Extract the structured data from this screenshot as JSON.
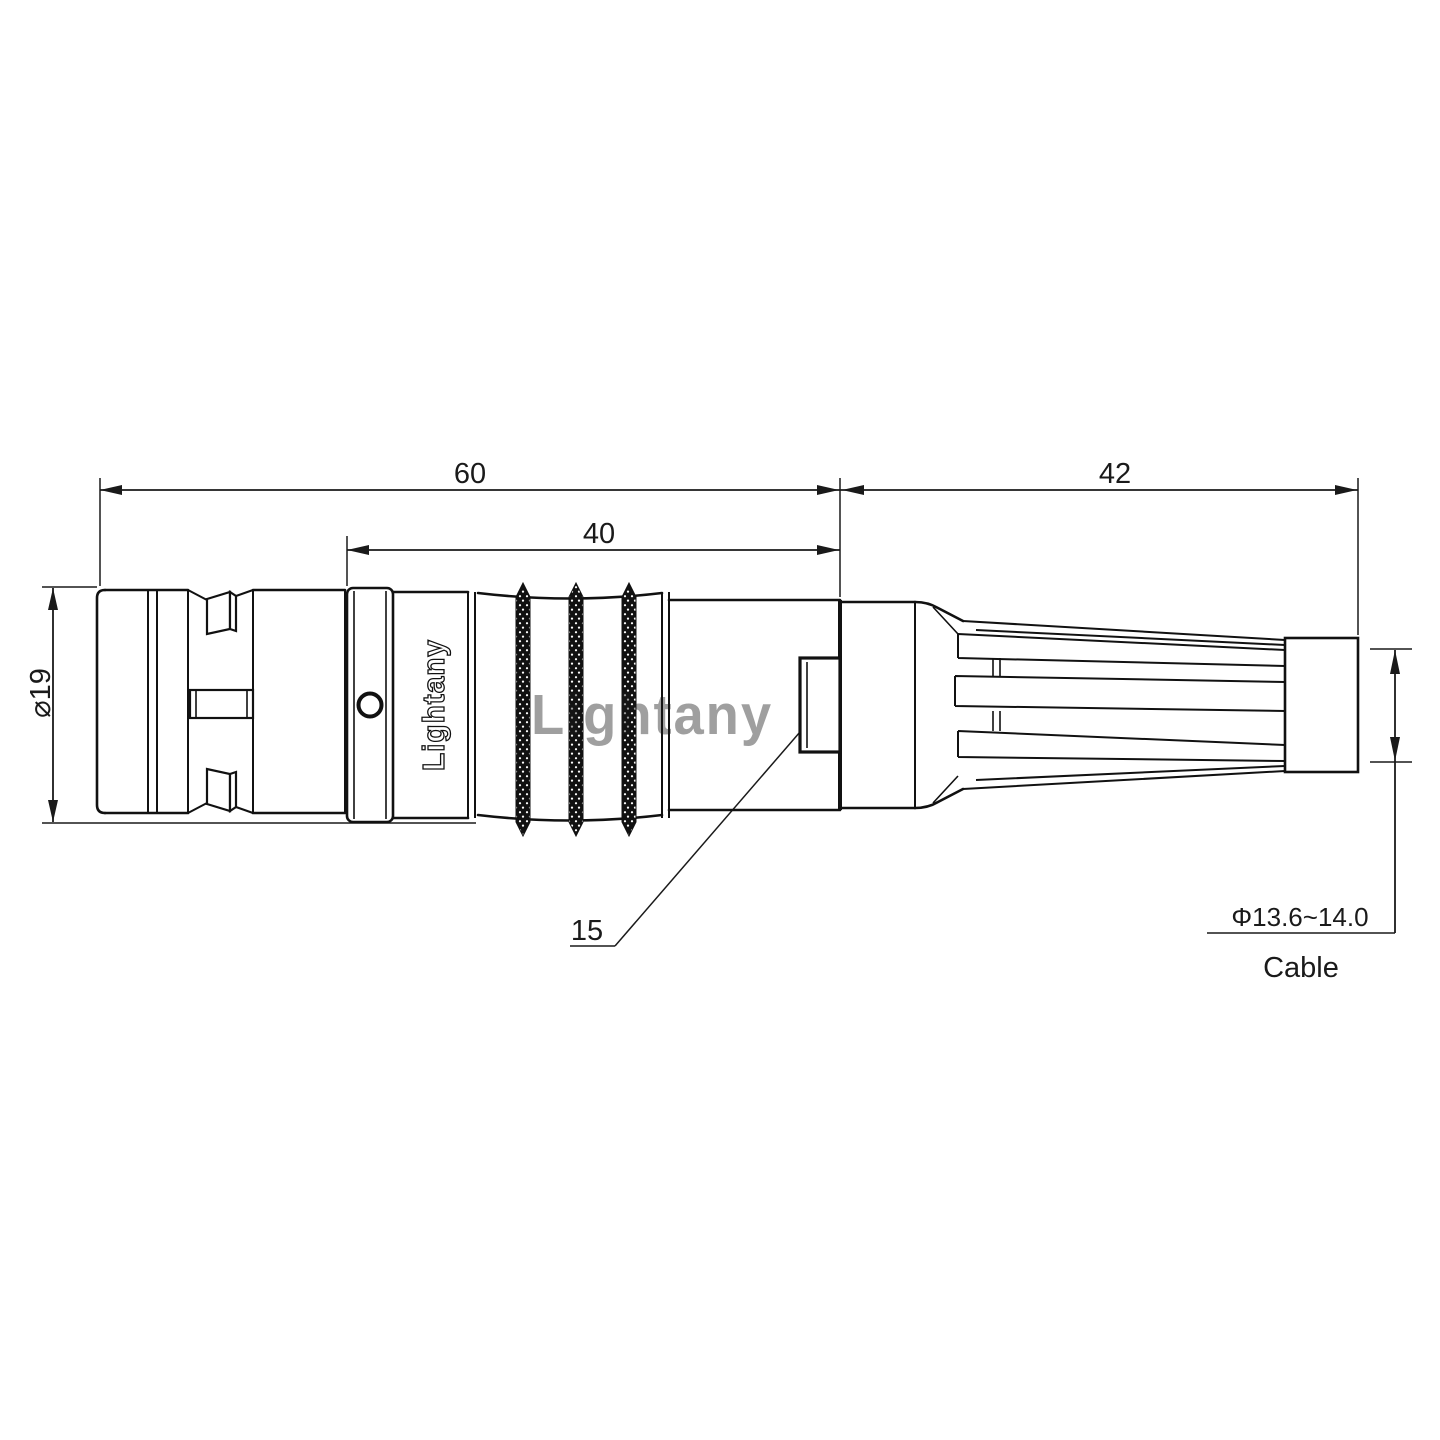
{
  "drawing": {
    "watermark": "Lightany",
    "body_marking": "Lightany",
    "labels": {
      "dim_overall": "60",
      "dim_body": "40",
      "dim_boot": "42",
      "dim_front_diameter": "⌀19",
      "dim_window": "15",
      "dim_cable_range": "Φ13.6~14.0",
      "cable": "Cable"
    },
    "colors": {
      "line": "#1a1a1a",
      "watermark": "#e06060"
    }
  }
}
